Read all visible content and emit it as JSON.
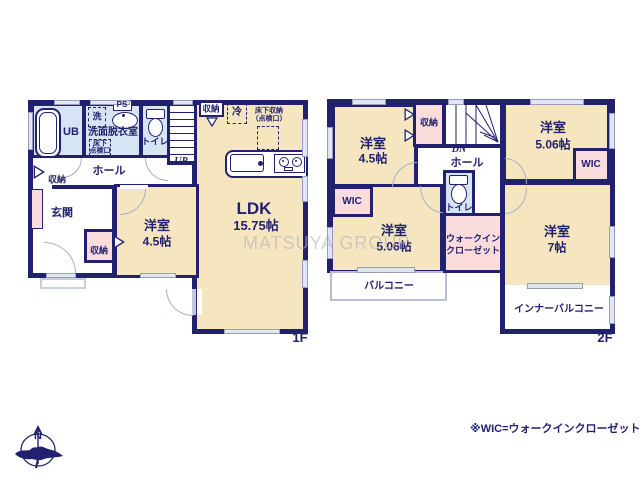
{
  "colors": {
    "wall": "#21216f",
    "cream": "#f6e6c0",
    "blue": "#d7e4f4",
    "pink": "#f9dcdb",
    "window": "#e2e6f3",
    "door_gray": "#a8aecb",
    "watermark": "#b5b5b5"
  },
  "watermark": "MATSUYA GROUP",
  "compass_n": "N",
  "footer": {
    "note": "※WIC=ウォークインクローゼット"
  },
  "floor1": {
    "floor_label": "1F",
    "ub": "UB",
    "laundry": "洗",
    "ps": "PS",
    "washroom": "洗面脱衣室",
    "hatch_top": "床下",
    "hatch_bottom": "点検口",
    "toilet": "トイレ",
    "stair_storage": "収納",
    "up": "UP",
    "fridge": "冷",
    "floor_storage_1": "床下収納",
    "floor_storage_2": "（点検口）",
    "hall": "ホール",
    "hall_storage": "収納",
    "entrance": "玄関",
    "closet": "収納",
    "bedroom": {
      "name": "洋室",
      "size": "4.5帖"
    },
    "ldk": {
      "name": "LDK",
      "size": "15.75帖"
    }
  },
  "floor2": {
    "floor_label": "2F",
    "bedroom1": {
      "name": "洋室",
      "size": "4.5帖"
    },
    "storage": "収納",
    "dn": "DN",
    "hall": "ホール",
    "toilet": "トイレ",
    "bedroom2": {
      "name": "洋室",
      "size": "5.06帖"
    },
    "wic_right": "WIC",
    "wic_left": "WIC",
    "bedroom3": {
      "name": "洋室",
      "size": "5.06帖"
    },
    "walkin1": "ウォークイン",
    "walkin2": "クローゼット",
    "bedroom4": {
      "name": "洋室",
      "size": "7帖"
    },
    "balcony": "バルコニー",
    "inner_balcony": "インナーバルコニー"
  }
}
